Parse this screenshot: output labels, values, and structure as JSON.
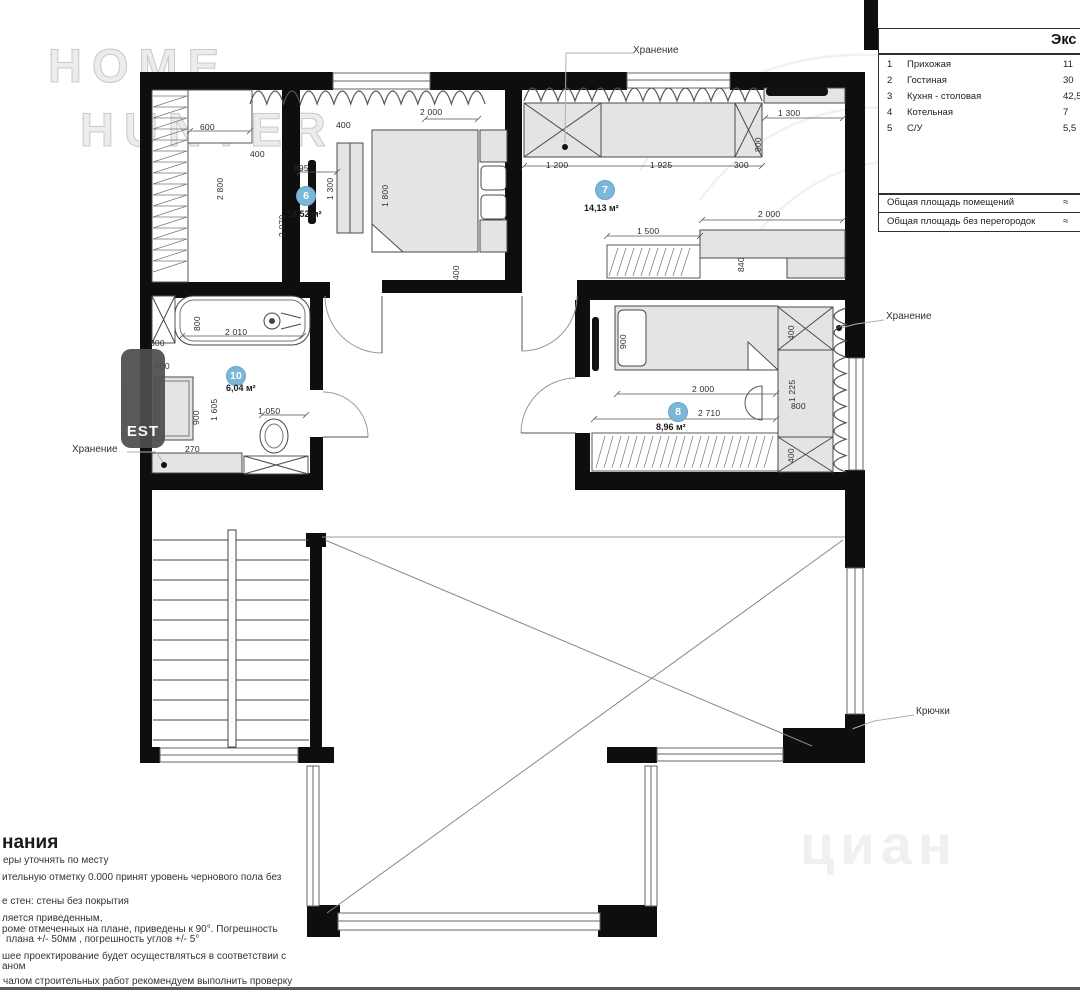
{
  "table": {
    "title": "Экс",
    "rows": [
      {
        "num": "1",
        "name": "Прихожая",
        "area": "11"
      },
      {
        "num": "2",
        "name": "Гостиная",
        "area": "30"
      },
      {
        "num": "3",
        "name": "Кухня - столовая",
        "area": "42,5"
      },
      {
        "num": "4",
        "name": "Котельная",
        "area": "7"
      },
      {
        "num": "5",
        "name": "С/У",
        "area": "5,5"
      }
    ],
    "footer": [
      {
        "label": "Общая площадь помещений",
        "value": "≈"
      },
      {
        "label": "Общая площадь без перегородок",
        "value": "≈"
      }
    ]
  },
  "plan": {
    "rooms": [
      {
        "number": "6",
        "area": "14,52 м²"
      },
      {
        "number": "7",
        "area": "14,13 м²"
      },
      {
        "number": "8",
        "area": "8,96 м²"
      },
      {
        "number": "10",
        "area": "6,04 м²"
      }
    ],
    "annotations": {
      "storage_top": "Хранение",
      "storage_right": "Хранение",
      "storage_left": "Хранение",
      "hooks": "Крючки"
    },
    "dimensions": {
      "horizontal": [
        {
          "t": "600",
          "x": 200,
          "y": 122
        },
        {
          "t": "400",
          "x": 250,
          "y": 149
        },
        {
          "t": "895",
          "x": 294,
          "y": 163
        },
        {
          "t": "400",
          "x": 336,
          "y": 120
        },
        {
          "t": "2 000",
          "x": 420,
          "y": 107
        },
        {
          "t": "1 200",
          "x": 546,
          "y": 160
        },
        {
          "t": "1 925",
          "x": 650,
          "y": 160
        },
        {
          "t": "300",
          "x": 734,
          "y": 160
        },
        {
          "t": "1 300",
          "x": 778,
          "y": 108
        },
        {
          "t": "2 000",
          "x": 758,
          "y": 209
        },
        {
          "t": "1 500",
          "x": 637,
          "y": 226
        },
        {
          "t": "2 010",
          "x": 225,
          "y": 327
        },
        {
          "t": "300",
          "x": 150,
          "y": 338
        },
        {
          "t": "500",
          "x": 155,
          "y": 361
        },
        {
          "t": "270",
          "x": 185,
          "y": 444
        },
        {
          "t": "1 050",
          "x": 258,
          "y": 406
        },
        {
          "t": "2 000",
          "x": 692,
          "y": 384
        },
        {
          "t": "2 710",
          "x": 698,
          "y": 408
        },
        {
          "t": "800",
          "x": 791,
          "y": 401
        }
      ],
      "vertical": [
        {
          "t": "2 800",
          "x": 215,
          "y": 200
        },
        {
          "t": "2 070",
          "x": 277,
          "y": 237
        },
        {
          "t": "1 300",
          "x": 325,
          "y": 200
        },
        {
          "t": "1 800",
          "x": 380,
          "y": 207
        },
        {
          "t": "400",
          "x": 451,
          "y": 280
        },
        {
          "t": "800",
          "x": 753,
          "y": 152
        },
        {
          "t": "840",
          "x": 736,
          "y": 272
        },
        {
          "t": "800",
          "x": 192,
          "y": 331
        },
        {
          "t": "900",
          "x": 191,
          "y": 425
        },
        {
          "t": "1 605",
          "x": 209,
          "y": 421
        },
        {
          "t": "900",
          "x": 618,
          "y": 349
        },
        {
          "t": "400",
          "x": 786,
          "y": 340
        },
        {
          "t": "1 225",
          "x": 787,
          "y": 402
        },
        {
          "t": "400",
          "x": 786,
          "y": 463
        }
      ]
    }
  },
  "notes": {
    "heading": "нания",
    "lines": [
      {
        "text": "еры уточнять по месту",
        "x": 3,
        "y": 855
      },
      {
        "text": "ительную отметку 0.000 принят уровень чернового пола без",
        "x": 2,
        "y": 872
      },
      {
        "text": "е стен: стены без покрытия",
        "x": 2,
        "y": 896
      },
      {
        "text": "ляется приведенным,",
        "x": 2,
        "y": 913
      },
      {
        "text": "роме отмеченных на плане, приведены к 90°.  Погрешность",
        "x": 2,
        "y": 924
      },
      {
        "text": "плана +/- 50мм , погрешность углов +/- 5°",
        "x": 6,
        "y": 934
      },
      {
        "text": "шее проектирование  будет осуществляться в соответствии с",
        "x": 2,
        "y": 951
      },
      {
        "text": "аном",
        "x": 2,
        "y": 961
      },
      {
        "text": "чалом строительных работ рекомендуем выполнить проверку",
        "x": 3,
        "y": 976
      }
    ]
  },
  "watermarks": {
    "home_line1": "HOME",
    "home_line2": "HUNTER",
    "est": "EST",
    "cian": "циан"
  },
  "colors": {
    "wall": "#0e0e0e",
    "furniture_fill": "#e4e4e4",
    "accent_circle": "#7db7d8",
    "leader": "#9fb6be"
  }
}
